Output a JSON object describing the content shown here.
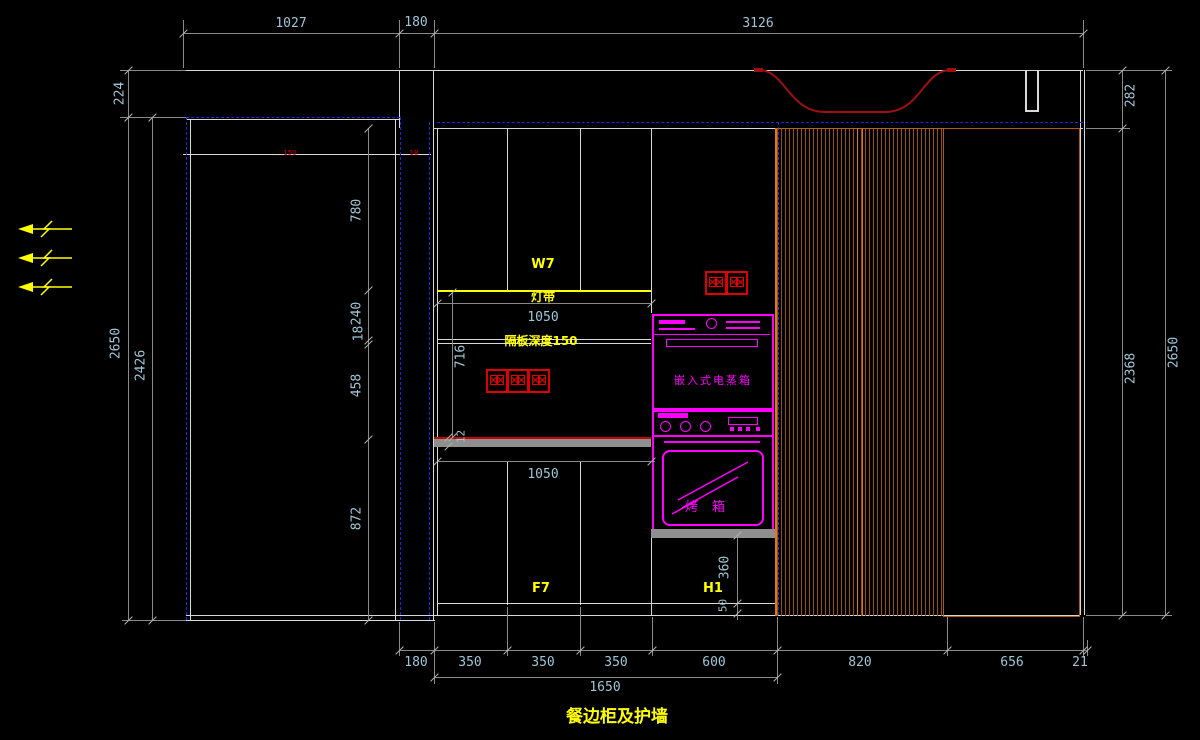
{
  "drawing_title": "餐边柜及护墙",
  "colors": {
    "background": "#000000",
    "line": "#d8d8d8",
    "dim_line": "#8a8a8a",
    "dim_text": "#9fc6d8",
    "accent_yellow": "#ffff00",
    "accent_magenta": "#ff00ff",
    "accent_red": "#e00000",
    "hood_red": "#9e1010",
    "wood_orange": "#c8641e",
    "dashed_blue": "#2222ee",
    "gray_bar": "#8f8f8f"
  },
  "dims": {
    "top": [
      "1027",
      "180",
      "3126"
    ],
    "left": {
      "d224": "224",
      "d2650": "2650",
      "d2426": "2426"
    },
    "left_chain": [
      "780",
      "240",
      "18",
      "458",
      "872"
    ],
    "right": {
      "d282": "282",
      "d2368": "2368",
      "d2650": "2650"
    },
    "bottom": [
      "180",
      "350",
      "350",
      "350",
      "600",
      "820",
      "656",
      "21"
    ],
    "bottom_total": "1650",
    "niche_width_top": "1050",
    "niche_width_bottom": "1050",
    "niche_height": "716",
    "counter_thickness": "12",
    "oven_base_height": "360",
    "kick_height": "50",
    "panel_note_left": "150",
    "panel_note_right": "18"
  },
  "labels": {
    "upper_cabinet": "W7",
    "light_strip": "灯带",
    "shelf_note": "隔板深度150",
    "lower_cabinet": "F7",
    "tall_unit": "H1",
    "steam_oven": "嵌入式电蒸箱",
    "oven": "烤箱"
  }
}
